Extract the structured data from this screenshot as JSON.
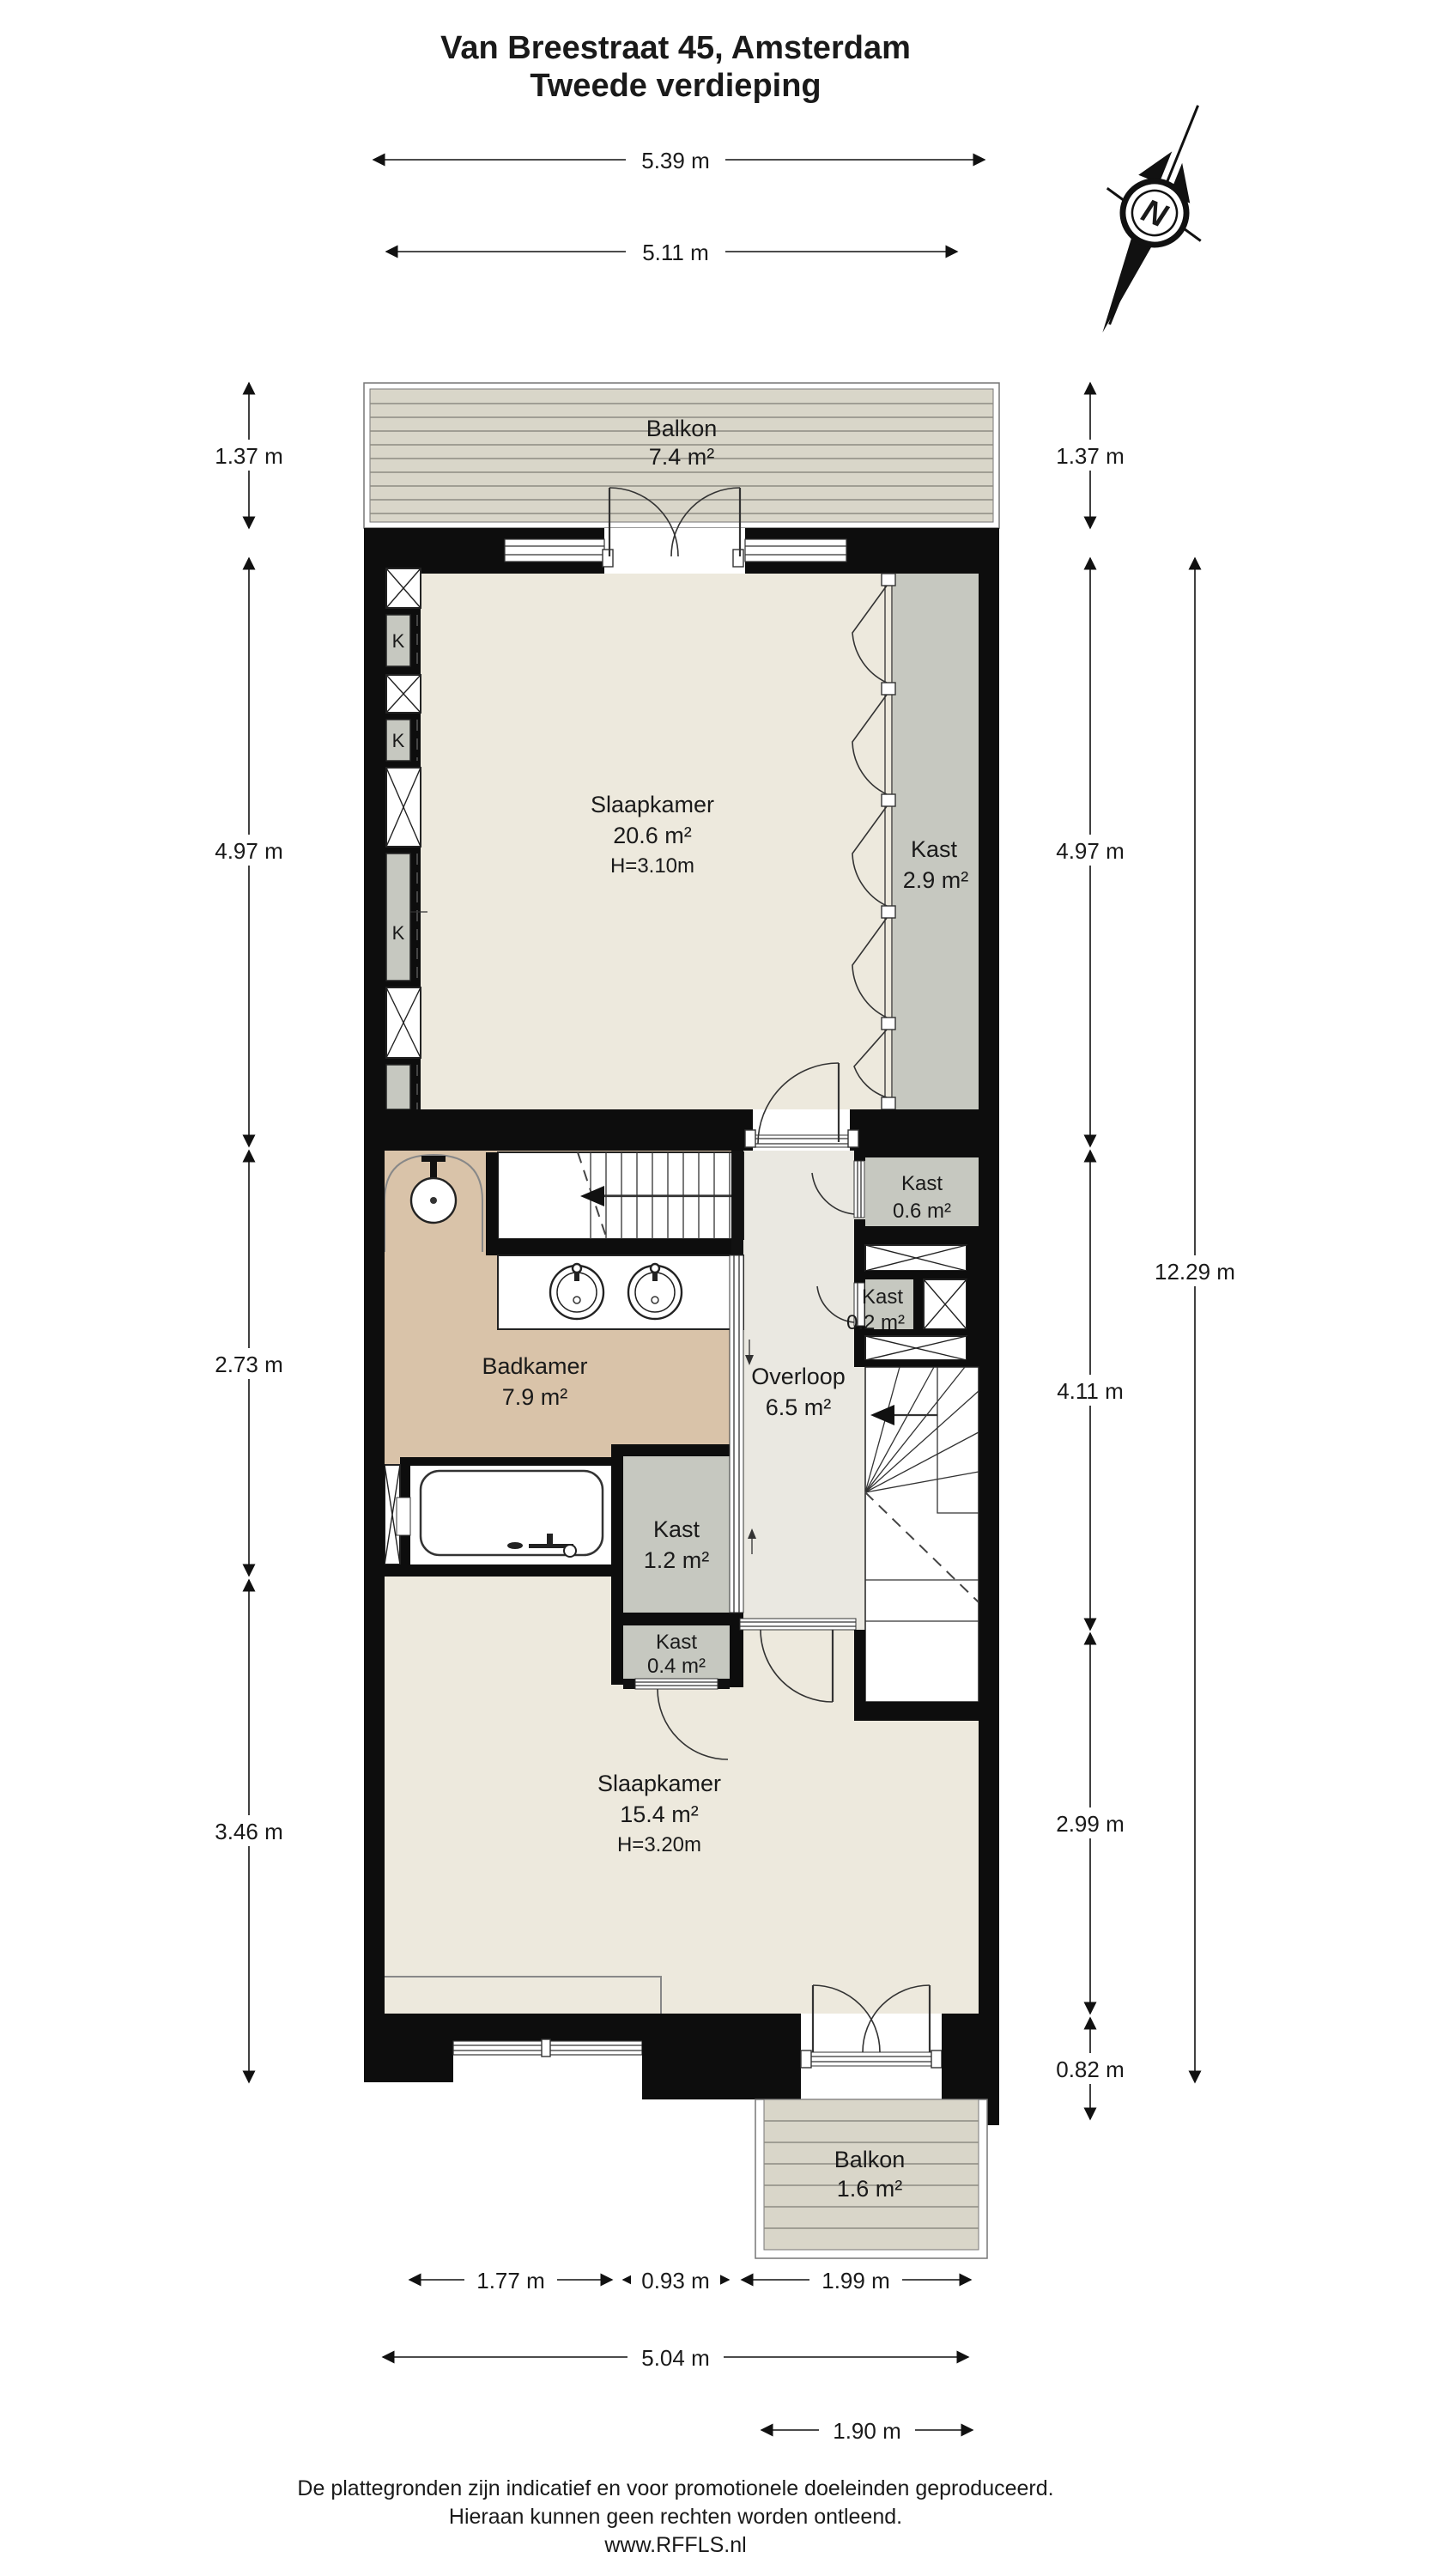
{
  "title": {
    "line1": "Van Breestraat 45, Amsterdam",
    "line2": "Tweede verdieping"
  },
  "compass": {
    "north_label": "N"
  },
  "rooms": {
    "balkon_top": {
      "name": "Balkon",
      "area": "7.4 m²"
    },
    "slaapkamer_1": {
      "name": "Slaapkamer",
      "area": "20.6 m²",
      "ceiling": "H=3.10m"
    },
    "kast_29": {
      "name": "Kast",
      "area": "2.9 m²"
    },
    "kast_06": {
      "name": "Kast",
      "area": "0.6 m²"
    },
    "kast_02": {
      "name": "Kast",
      "area": "0.2 m²"
    },
    "badkamer": {
      "name": "Badkamer",
      "area": "7.9 m²"
    },
    "overloop": {
      "name": "Overloop",
      "area": "6.5 m²"
    },
    "kast_12": {
      "name": "Kast",
      "area": "1.2 m²"
    },
    "kast_04": {
      "name": "Kast",
      "area": "0.4 m²"
    },
    "slaapkamer_2": {
      "name": "Slaapkamer",
      "area": "15.4 m²",
      "ceiling": "H=3.20m"
    },
    "balkon_bottom": {
      "name": "Balkon",
      "area": "1.6 m²"
    },
    "closet_mark": "K"
  },
  "dimensions": {
    "top": {
      "outer": "5.39 m",
      "inner": "5.11 m"
    },
    "left": {
      "d1": "1.37 m",
      "d2": "4.97 m",
      "d3": "2.73 m",
      "d4": "3.46 m"
    },
    "right": {
      "d1": "1.37 m",
      "d2": "4.97 m",
      "d3": "4.11 m",
      "d4": "2.99 m",
      "d5": "0.82 m",
      "total": "12.29 m"
    },
    "bottom": {
      "d1": "1.77 m",
      "d2": "0.93 m",
      "d3": "1.99 m",
      "inner": "5.04 m",
      "outer": "1.90 m"
    }
  },
  "footer": {
    "line1": "De plattegronden zijn indicatief en voor promotionele doeleinden geproduceerd.",
    "line2": "Hieraan kunnen geen rechten worden ontleend.",
    "line3": "www.RFFLS.nl"
  },
  "colors": {
    "wall": "#0d0d0d",
    "room": "#EDE9DD",
    "bathroom": "#D9C3A9",
    "closet": "#C6C8C0",
    "landing": "#EAE8E1",
    "deck": "#D9D6C9",
    "deck_stripe": "#8E8C83"
  }
}
